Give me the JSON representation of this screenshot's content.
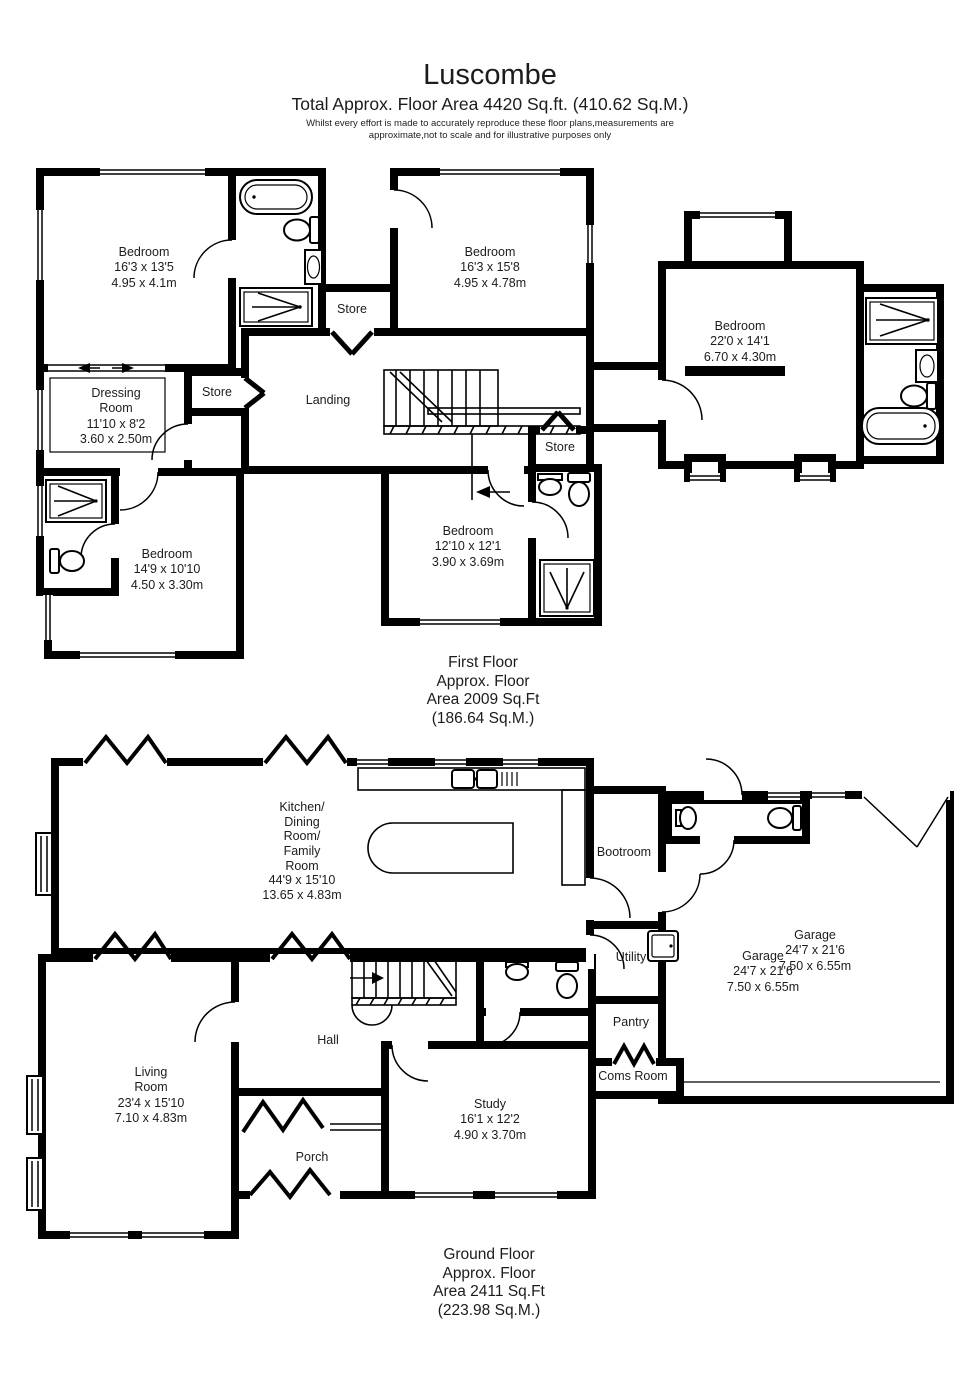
{
  "header": {
    "title": "Luscombe",
    "subtitle": "Total Approx. Floor Area 4420 Sq.ft. (410.62 Sq.M.)",
    "disclaimer": "Whilst every effort is made to accurately reproduce these floor plans,measurements are\napproximate,not to scale and for illustrative purposes only"
  },
  "first_floor": {
    "caption": "First Floor\nApprox. Floor\nArea 2009 Sq.Ft\n(186.64 Sq.M.)",
    "rooms": {
      "bedroom_1": "Bedroom\n16'3 x 13'5\n4.95 x 4.1m",
      "bedroom_2": "Bedroom\n16'3 x 15'8\n4.95 x 4.78m",
      "bedroom_3": "Bedroom\n22'0 x 14'1\n6.70 x 4.30m",
      "bedroom_4": "Bedroom\n14'9 x 10'10\n4.50 x 3.30m",
      "bedroom_5": "Bedroom\n12'10 x 12'1\n3.90 x 3.69m",
      "dressing_room": "Dressing\nRoom\n11'10 x 8'2\n3.60 x 2.50m",
      "landing": "Landing",
      "store_top": "Store",
      "store_left": "Store",
      "store_right": "Store"
    }
  },
  "ground_floor": {
    "caption": "Ground Floor\nApprox. Floor\nArea 2411 Sq.Ft\n(223.98 Sq.M.)",
    "rooms": {
      "kitchen": "Kitchen/\nDining\nRoom/\nFamily\nRoom\n44'9 x 15'10\n13.65 x 4.83m",
      "bootroom": "Bootroom",
      "utility": "Utility",
      "pantry": "Pantry",
      "coms_room": "Coms Room",
      "garage_label_1": "Garage\n24'7 x 21'6\n7.50 x 6.55m",
      "garage_label_2": "Garage\n24'7 x 21'6\n7.50 x 6.55m",
      "living_room": "Living\nRoom\n23'4 x 15'10\n7.10 x 4.83m",
      "hall": "Hall",
      "study": "Study\n16'1 x 12'2\n4.90 x 3.70m",
      "porch": "Porch"
    }
  }
}
